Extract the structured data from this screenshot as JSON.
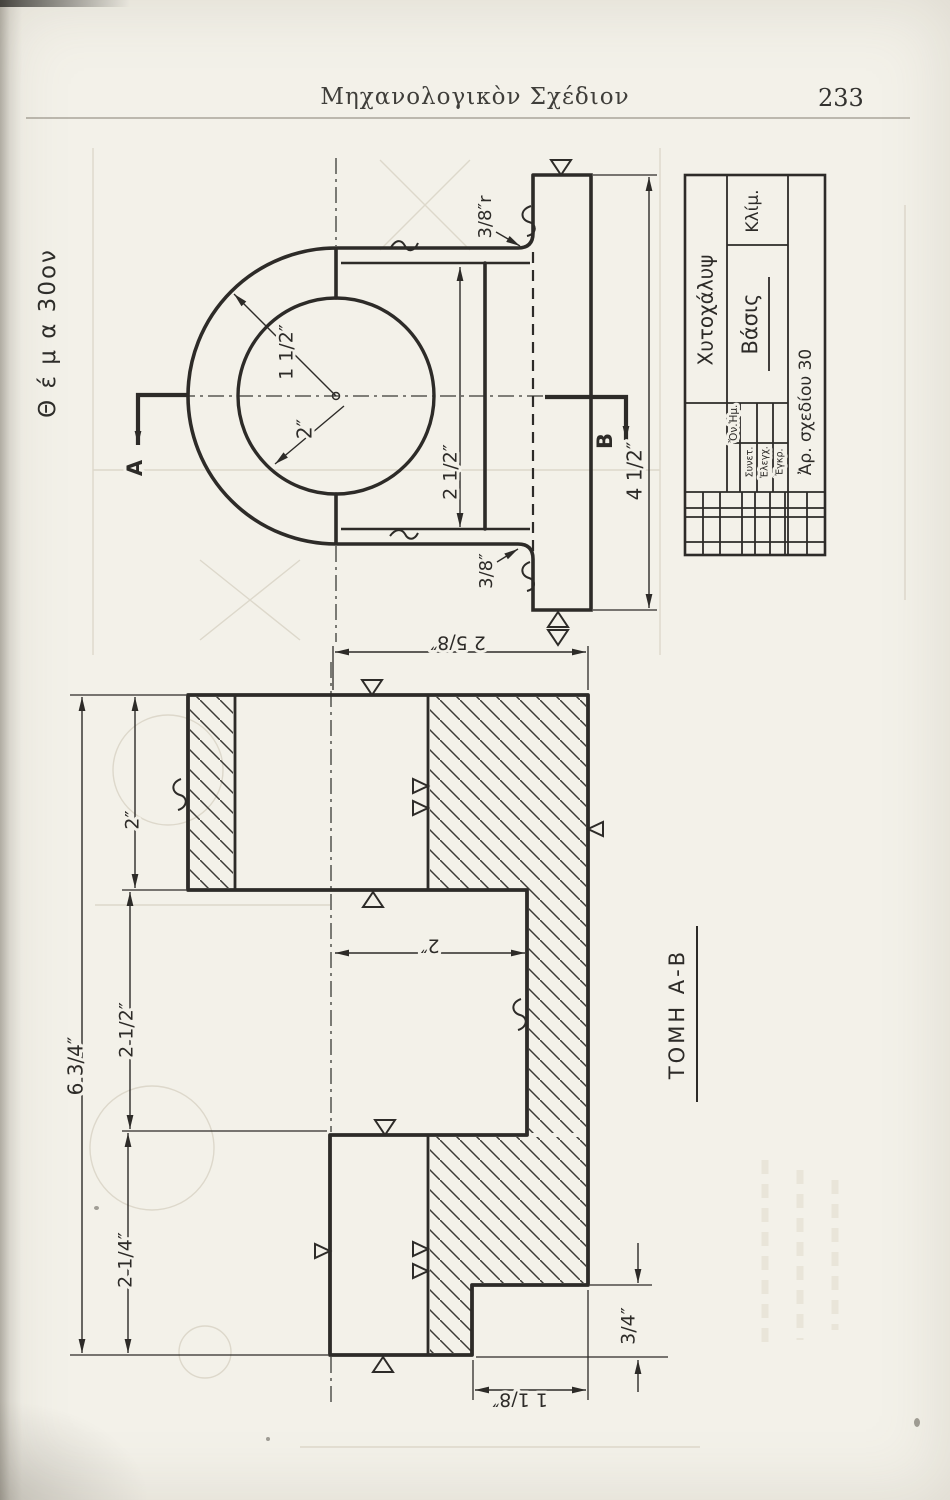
{
  "page": {
    "header_title": "Μηχανολογικὸν Σχέδιον",
    "page_number": "233",
    "theme_label": "Θ έ μ α  30ον"
  },
  "front_view": {
    "cut_label_a": "A",
    "cut_label_b": "B",
    "dim_radius": "1 1/2″",
    "dim_bore": "2″",
    "dim_depth": "2 1/2″",
    "dim_fillet_top": "3/8″r",
    "dim_fillet_bottom": "3/8″",
    "dim_plate_length": "4 1/2″"
  },
  "section_view": {
    "title": "ΤΟΜΗ Α-Β",
    "dim_top_width": "2 5/8″",
    "dim_web": "2″",
    "dim_total_height": "6 3/4″",
    "dim_seg_top": "2″",
    "dim_seg_mid": "2 1/2″",
    "dim_seg_bottom": "2 1/4″",
    "dim_foot_height": "3/4″",
    "dim_foot_width": "1 1/8″"
  },
  "title_block": {
    "material": "Χυτοχάλυψ",
    "part_name": "Βάσις",
    "scale_label": "Κλίμ.",
    "drawing_no": "Ἀρ. σχεδίου 30",
    "sig_col_date": "Ἡμ.",
    "sig_col_name": "Ὄν.",
    "sig_rows": [
      "Συνετ.",
      "Ἐλεγχ.",
      "Ἐγκρ."
    ]
  }
}
